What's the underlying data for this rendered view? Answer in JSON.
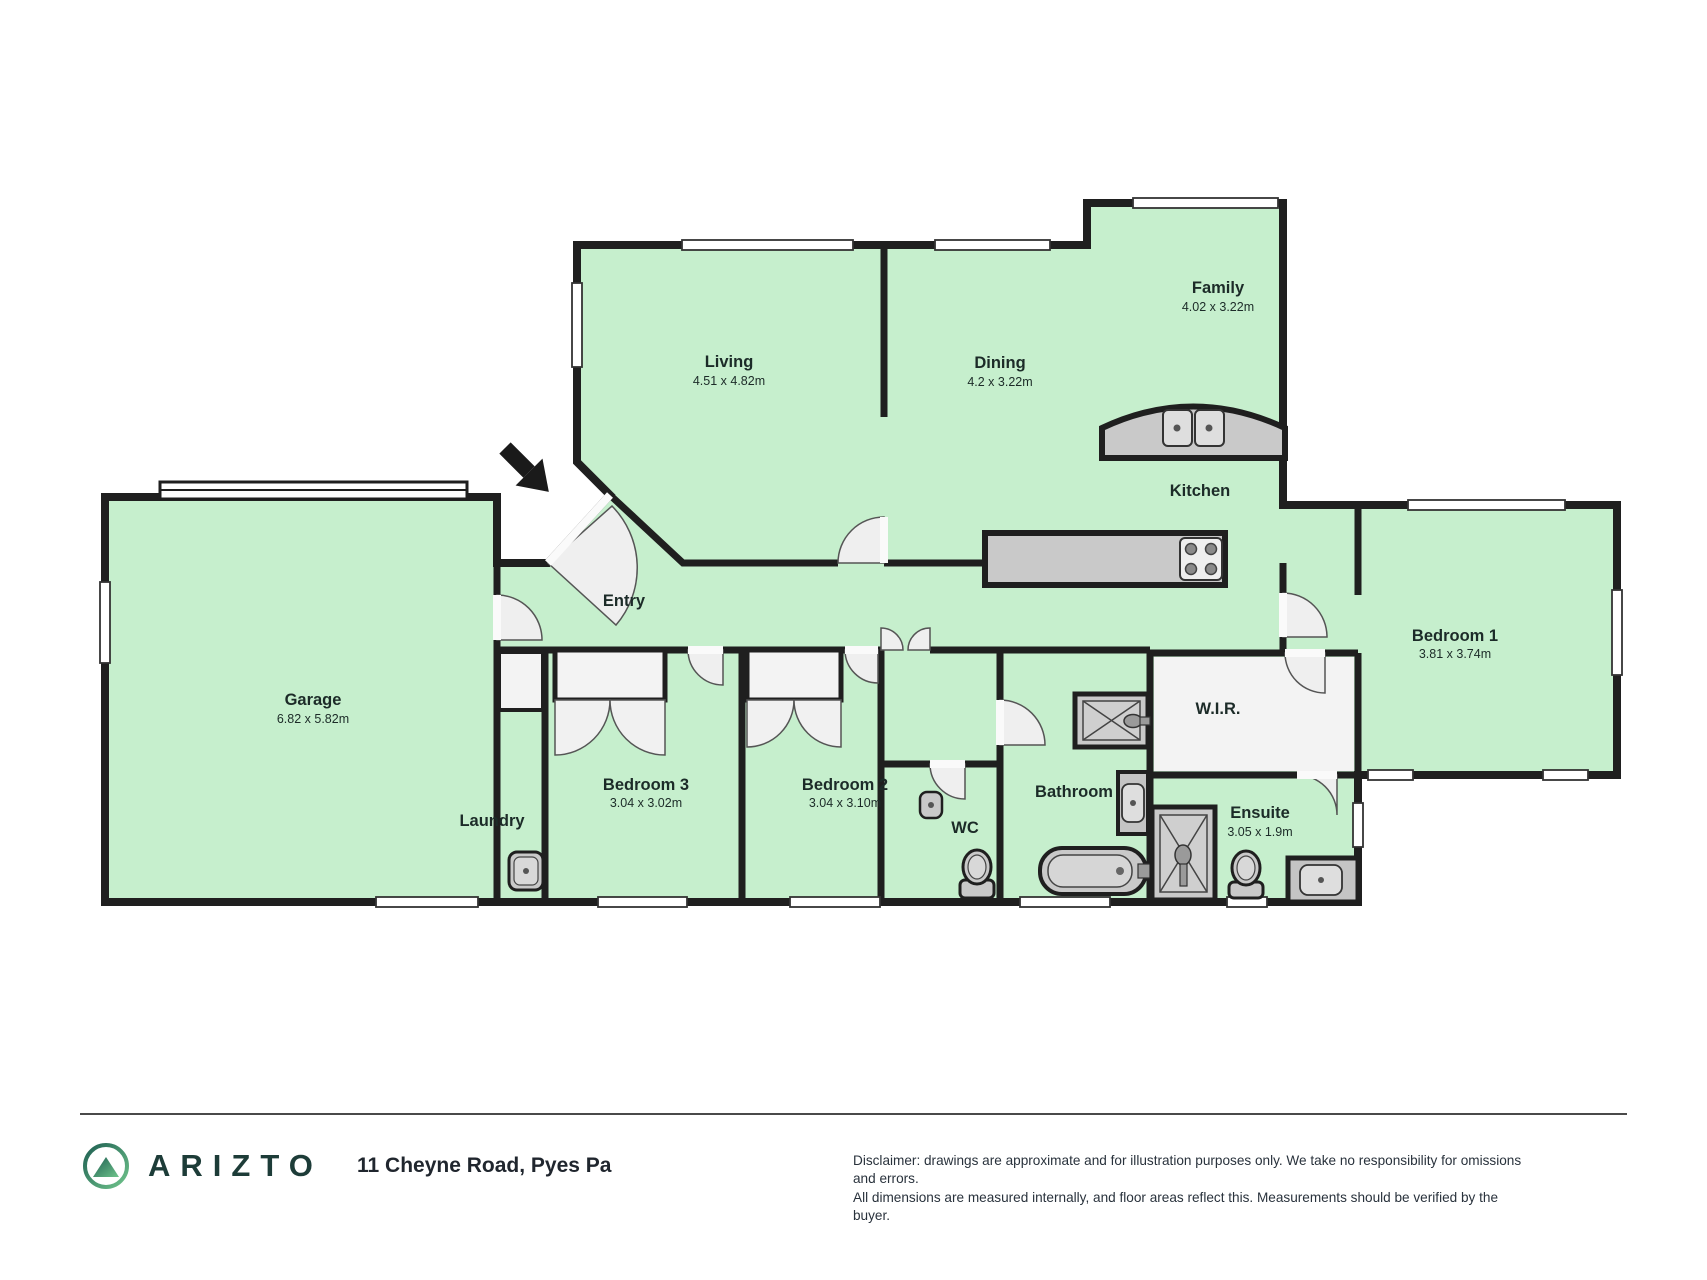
{
  "floorplan": {
    "rooms": {
      "living": {
        "label": "Living",
        "dims": "4.51 x 4.82m"
      },
      "dining": {
        "label": "Dining",
        "dims": "4.2 x 3.22m"
      },
      "family": {
        "label": "Family",
        "dims": "4.02 x 3.22m"
      },
      "kitchen": {
        "label": "Kitchen"
      },
      "entry": {
        "label": "Entry"
      },
      "garage": {
        "label": "Garage",
        "dims": "6.82 x 5.82m"
      },
      "laundry": {
        "label": "Laundry"
      },
      "bedroom3": {
        "label": "Bedroom 3",
        "dims": "3.04 x 3.02m"
      },
      "bedroom2": {
        "label": "Bedroom 2",
        "dims": "3.04 x 3.10m"
      },
      "wc": {
        "label": "WC"
      },
      "bathroom": {
        "label": "Bathroom"
      },
      "wir": {
        "label": "W.I.R."
      },
      "ensuite": {
        "label": "Ensuite",
        "dims": "3.05 x 1.9m"
      },
      "bedroom1": {
        "label": "Bedroom 1",
        "dims": "3.81 x 3.74m"
      }
    },
    "colors": {
      "floor_green": "#c6efcd",
      "wall": "#1f1f1f",
      "fixture_gray": "#c9c9c9",
      "door_white": "#f1f1f1",
      "closet_white": "#f3f3f3"
    }
  },
  "footer": {
    "brand": "ARIZTO",
    "address": "11 Cheyne Road, Pyes Pa",
    "disclaimer_line1": "Disclaimer: drawings are approximate and for illustration purposes only. We take no responsibility for omissions and errors.",
    "disclaimer_line2": "All dimensions are measured internally, and floor areas reflect this. Measurements should be verified by the buyer."
  }
}
